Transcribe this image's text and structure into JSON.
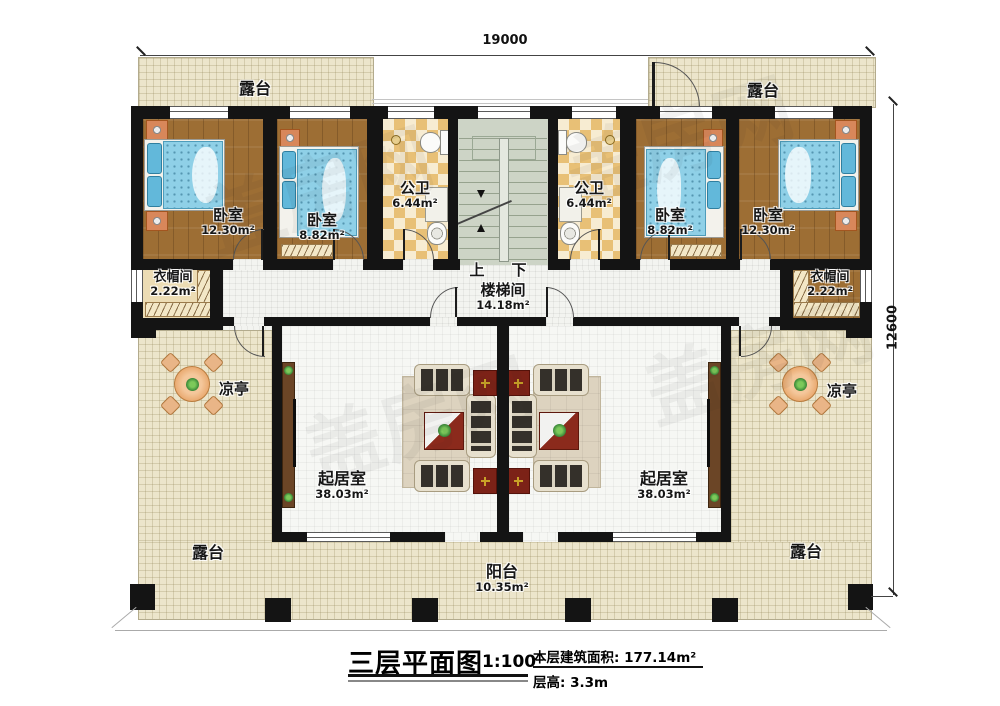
{
  "dimensions": {
    "width_top": "19000",
    "height_right": "12600"
  },
  "rooms": {
    "terrace_top_left": {
      "name": "露台"
    },
    "terrace_top_right": {
      "name": "露台"
    },
    "bedroom_left_large": {
      "name": "卧室",
      "area": "12.30m²"
    },
    "bedroom_left_small": {
      "name": "卧室",
      "area": "8.82m²"
    },
    "bath_left": {
      "name": "公卫",
      "area": "6.44m²"
    },
    "bath_right": {
      "name": "公卫",
      "area": "6.44m²"
    },
    "bedroom_right_small": {
      "name": "卧室",
      "area": "8.82m²"
    },
    "bedroom_right_large": {
      "name": "卧室",
      "area": "12.30m²"
    },
    "cloak_left": {
      "name": "衣帽间",
      "area": "2.22m²"
    },
    "cloak_right": {
      "name": "衣帽间",
      "area": "2.22m²"
    },
    "stairwell": {
      "name": "楼梯间",
      "area": "14.18m²",
      "up": "上",
      "down": "下"
    },
    "pavilion_left": {
      "name": "凉亭"
    },
    "pavilion_right": {
      "name": "凉亭"
    },
    "living_left": {
      "name": "起居室",
      "area": "38.03m²"
    },
    "living_right": {
      "name": "起居室",
      "area": "38.03m²"
    },
    "terrace_bottom_left": {
      "name": "露台"
    },
    "terrace_bottom_right": {
      "name": "露台"
    },
    "balcony": {
      "name": "阳台",
      "area": "10.35m²"
    }
  },
  "title": {
    "main": "三层平面图",
    "scale": "1:100",
    "area": "本层建筑面积: 177.14m²",
    "floor_height": "层高: 3.3m"
  },
  "watermark": "盖房网"
}
